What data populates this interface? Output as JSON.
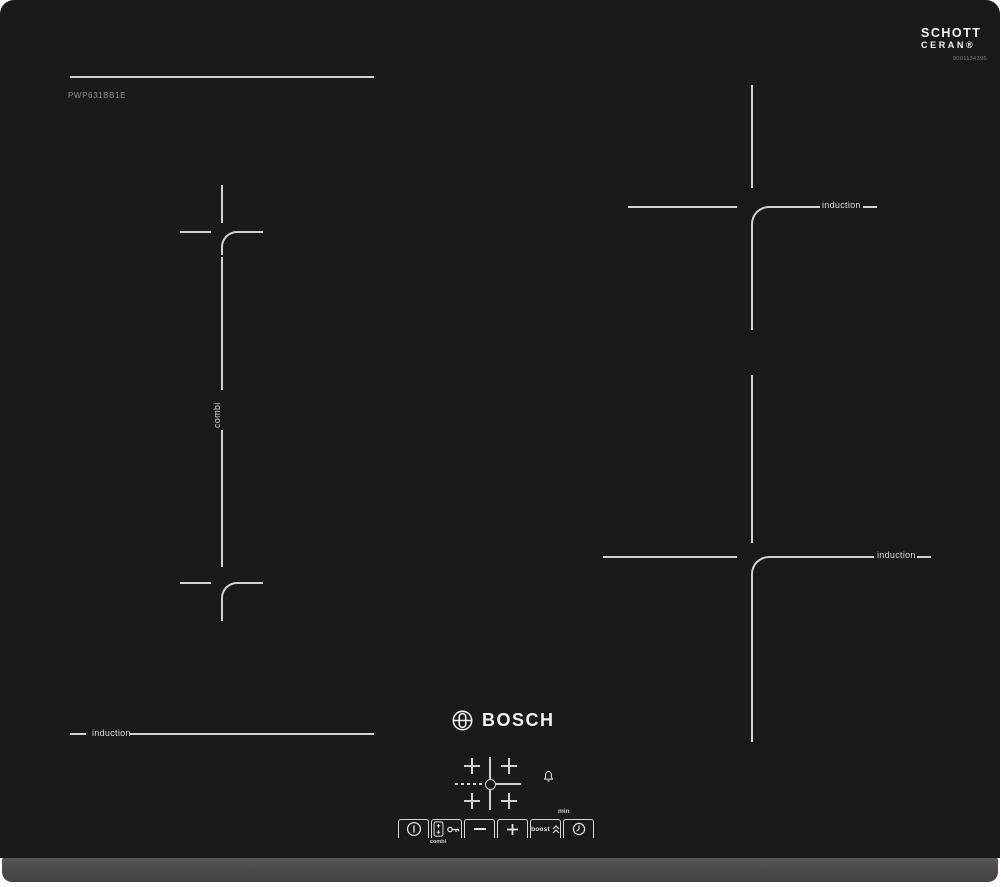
{
  "product": {
    "brand": "BOSCH",
    "model": "PWP631BB1E"
  },
  "glass_badge": {
    "brand_line1": "SCHOTT",
    "brand_line2": "CERAN®",
    "serial": "9001134395"
  },
  "zones": {
    "flex_left": {
      "combi_label": "combi",
      "induction_label": "induction"
    },
    "top_right": {
      "induction_label": "induction"
    },
    "bottom_right": {
      "induction_label": "induction"
    }
  },
  "controls": {
    "combi_label": "combi",
    "boost_label": "boost",
    "minutes_label": "min",
    "icons": [
      "power-icon",
      "flex-zone-icon",
      "key-lock-icon",
      "minus-icon",
      "plus-icon",
      "boost-chevrons-icon",
      "timer-clock-icon",
      "bell-icon",
      "zone-selector-crosses"
    ]
  },
  "colors": {
    "glass": "#1c1a19",
    "marking": "#d2d1ce",
    "trim": "#4e4b49",
    "background": "#ffffff",
    "logo_text": "#f2f2f0"
  }
}
